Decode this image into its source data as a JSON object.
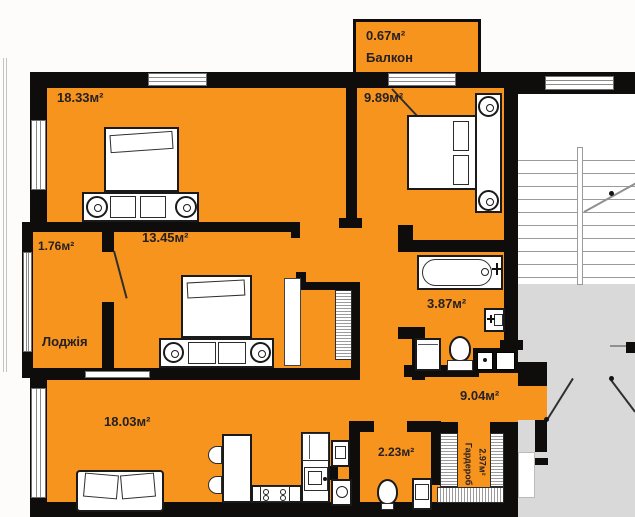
{
  "title": "3-room apartment floor plan",
  "colors": {
    "orange": "#F6941E",
    "wall": "#0E0D0B",
    "ink": "#262022",
    "stair": "#9B9B9B",
    "landing": "#D9D9D9"
  },
  "rooms": {
    "balcony": {
      "area": "0.67м²",
      "name": "Балкон"
    },
    "bedroom_top_left": {
      "area": "18.33м²"
    },
    "bedroom_top_right": {
      "area": "9.89м²"
    },
    "bedroom_middle": {
      "area": "13.45м²"
    },
    "loggia": {
      "area": "1.76м²",
      "name": "Лоджія"
    },
    "bathroom": {
      "area": "3.87м²"
    },
    "living_kitchen": {
      "area": "18.03м²"
    },
    "hallway": {
      "area": "9.04м²"
    },
    "wc": {
      "area": "2.23м²"
    },
    "wardrobe": {
      "area": "2.97м²",
      "name": "Гардероб"
    }
  }
}
